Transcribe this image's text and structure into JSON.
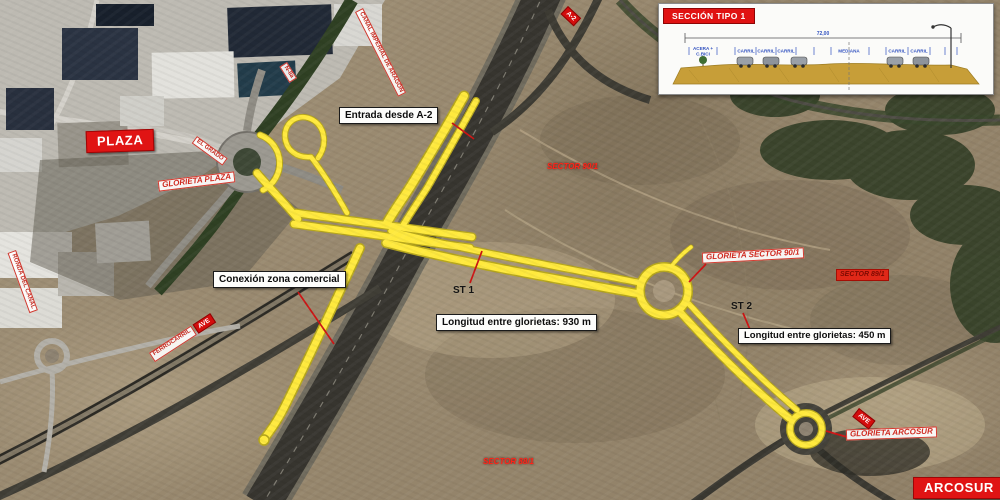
{
  "map": {
    "place_labels": {
      "plaza": "PLAZA",
      "arcosur": "ARCOSUR"
    },
    "glorietas": {
      "plaza": "GLORIETA PLAZA",
      "sector": "GLORIETA SECTOR 90/1",
      "arcosur": "GLORIETA ARCOSUR"
    },
    "annotations": {
      "entrada": "Entrada desde A-2",
      "conexion": "Conexión zona comercial",
      "longitud_930": "Longitud entre glorietas: 930 m",
      "longitud_450": "Longitud entre glorietas: 450 m",
      "st1": "ST 1",
      "st2": "ST 2"
    },
    "sectors": {
      "north": "SECTOR 90/1",
      "east": "SECTOR 89/1",
      "south": "SECTOR 88/1"
    },
    "road_labels": {
      "canal": "CANAL IMPERIAL DE ARAGÓN",
      "a2_shield": "A-2",
      "el_grado": "EL GRADO",
      "n2": "N-IIa",
      "ferrocarril": "FERROCARRIL",
      "ave": "AVE",
      "ronda": "RONDA DEL CANAL",
      "ave_sur": "AVE"
    }
  },
  "section_panel": {
    "title": "SECCIÓN TIPO 1",
    "total_width_label": "72,00",
    "lane_labels": [
      "ACERA +",
      "C.BICI",
      "CARRIL",
      "CARRIL",
      "CARRIL",
      "MEDIANA",
      "CARRIL",
      "CARRIL"
    ]
  },
  "colors": {
    "highlight_road": "#ffe93d",
    "annotation_red": "#e01414",
    "section_dim_blue": "#3353c0"
  }
}
